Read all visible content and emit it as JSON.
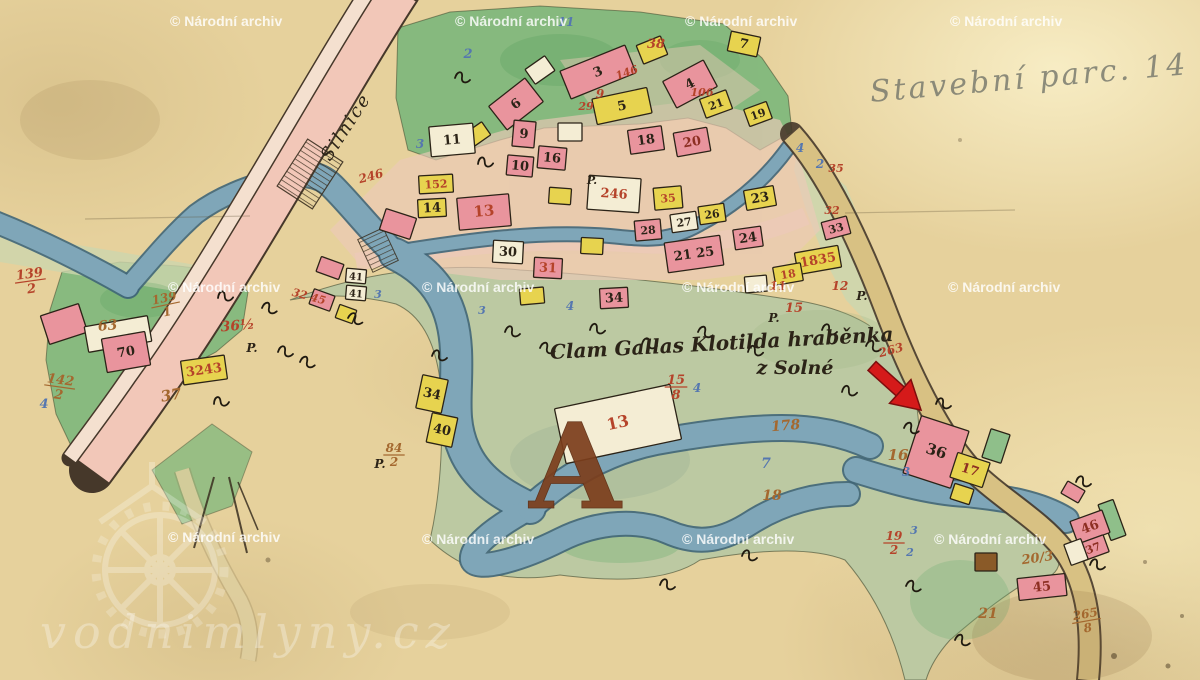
{
  "palette": {
    "paper": "#e6d19c",
    "ink": "#2b2317",
    "pencil": "#73756a",
    "road_pink": "#f2c7b8",
    "road_strip": "#f4e0cf",
    "street_wash": "#ecc9b8",
    "river": "#7fa6b8",
    "tan_road": "#d8c183",
    "path_tan": "#decf9f",
    "green_bright": "#7eb87c",
    "green_sage": "#bcc9a2",
    "green_pale": "#cdd6ae",
    "bldg_pink": "#e9949d",
    "bldg_red": "#dd7580",
    "bldg_yellow": "#e7d34f",
    "bldg_cream": "#f4edd4",
    "bldg_brown": "#8a5a28",
    "bldg_green": "#8fbf8a",
    "label_red": "#b5432a",
    "label_brown": "#a4682f",
    "label_blue": "#5577b0",
    "label_darkred": "#8d2f23",
    "arrow_red": "#d51a1a",
    "arrow_dark": "#7e0d0d"
  },
  "watermark": {
    "text": "© Národní archiv",
    "positions": [
      {
        "x": 170,
        "y": 14
      },
      {
        "x": 455,
        "y": 14
      },
      {
        "x": 685,
        "y": 14
      },
      {
        "x": 950,
        "y": 14
      },
      {
        "x": 168,
        "y": 280
      },
      {
        "x": 422,
        "y": 280
      },
      {
        "x": 682,
        "y": 280
      },
      {
        "x": 948,
        "y": 280
      },
      {
        "x": 168,
        "y": 530
      },
      {
        "x": 422,
        "y": 532
      },
      {
        "x": 682,
        "y": 532
      },
      {
        "x": 934,
        "y": 532
      }
    ]
  },
  "brand": {
    "text": "vodnimlyny.cz"
  },
  "inscriptions": {
    "road": "Silnice",
    "manor1": "Clam Gallas Klotilda hraběnka",
    "manor2": "z Solné",
    "pencil": "Stavební parc. 14",
    "letter": "A"
  },
  "map": {
    "buildings": [
      {
        "x": 598,
        "y": 72,
        "w": 70,
        "h": 30,
        "r": -22,
        "c": "p",
        "t": "3"
      },
      {
        "x": 652,
        "y": 50,
        "w": 26,
        "h": 20,
        "r": -22,
        "c": "y"
      },
      {
        "x": 690,
        "y": 84,
        "w": 46,
        "h": 30,
        "r": -28,
        "c": "p",
        "t": "4"
      },
      {
        "x": 622,
        "y": 106,
        "w": 56,
        "h": 26,
        "r": -12,
        "c": "y",
        "t": "5"
      },
      {
        "x": 540,
        "y": 70,
        "w": 24,
        "h": 18,
        "r": -35,
        "c": "w"
      },
      {
        "x": 516,
        "y": 104,
        "w": 46,
        "h": 30,
        "r": -38,
        "c": "p",
        "t": "6"
      },
      {
        "x": 744,
        "y": 44,
        "w": 30,
        "h": 20,
        "r": 12,
        "c": "y",
        "t": "7"
      },
      {
        "x": 716,
        "y": 104,
        "w": 28,
        "h": 20,
        "r": -20,
        "c": "y",
        "t": "21",
        "fs": 11
      },
      {
        "x": 758,
        "y": 114,
        "w": 24,
        "h": 18,
        "r": -20,
        "c": "y",
        "t": "19",
        "fs": 11
      },
      {
        "x": 646,
        "y": 140,
        "w": 34,
        "h": 24,
        "r": -8,
        "c": "p",
        "t": "18"
      },
      {
        "x": 692,
        "y": 142,
        "w": 34,
        "h": 24,
        "r": -10,
        "c": "p",
        "t": "20",
        "tc": "dr"
      },
      {
        "x": 570,
        "y": 132,
        "w": 24,
        "h": 18,
        "r": 0,
        "c": "w"
      },
      {
        "x": 478,
        "y": 134,
        "w": 20,
        "h": 16,
        "r": -35,
        "c": "y"
      },
      {
        "x": 452,
        "y": 140,
        "w": 44,
        "h": 30,
        "r": -5,
        "c": "w",
        "t": "11"
      },
      {
        "x": 524,
        "y": 134,
        "w": 22,
        "h": 26,
        "r": 5,
        "c": "p",
        "t": "9"
      },
      {
        "x": 520,
        "y": 166,
        "w": 26,
        "h": 20,
        "r": 5,
        "c": "p",
        "t": "10"
      },
      {
        "x": 552,
        "y": 158,
        "w": 28,
        "h": 22,
        "r": 5,
        "c": "p",
        "t": "16"
      },
      {
        "x": 436,
        "y": 184,
        "w": 34,
        "h": 18,
        "r": -3,
        "c": "y",
        "t": "152",
        "tc": "r",
        "fs": 11
      },
      {
        "x": 432,
        "y": 208,
        "w": 28,
        "h": 18,
        "r": -3,
        "c": "y",
        "t": "14"
      },
      {
        "x": 484,
        "y": 212,
        "w": 52,
        "h": 32,
        "r": -5,
        "c": "p",
        "t": "13",
        "tc": "r",
        "fs": 15
      },
      {
        "x": 398,
        "y": 224,
        "w": 32,
        "h": 22,
        "r": 18,
        "c": "p"
      },
      {
        "x": 560,
        "y": 196,
        "w": 22,
        "h": 16,
        "r": 4,
        "c": "y"
      },
      {
        "x": 614,
        "y": 194,
        "w": 52,
        "h": 34,
        "r": 4,
        "c": "cr",
        "t": "246",
        "tc": "r"
      },
      {
        "x": 668,
        "y": 198,
        "w": 28,
        "h": 22,
        "r": -5,
        "c": "y",
        "t": "35",
        "tc": "r",
        "fs": 11
      },
      {
        "x": 684,
        "y": 222,
        "w": 26,
        "h": 18,
        "r": -8,
        "c": "w",
        "t": "27",
        "fs": 11
      },
      {
        "x": 712,
        "y": 214,
        "w": 26,
        "h": 18,
        "r": -8,
        "c": "y",
        "t": "26",
        "fs": 11
      },
      {
        "x": 760,
        "y": 198,
        "w": 30,
        "h": 20,
        "r": -10,
        "c": "y",
        "t": "23"
      },
      {
        "x": 508,
        "y": 252,
        "w": 30,
        "h": 22,
        "r": 3,
        "c": "w",
        "t": "30"
      },
      {
        "x": 548,
        "y": 268,
        "w": 28,
        "h": 20,
        "r": 3,
        "c": "p",
        "t": "31",
        "tc": "r"
      },
      {
        "x": 592,
        "y": 246,
        "w": 22,
        "h": 16,
        "r": 3,
        "c": "y"
      },
      {
        "x": 648,
        "y": 230,
        "w": 26,
        "h": 20,
        "r": -5,
        "c": "p",
        "t": "28",
        "fs": 11
      },
      {
        "x": 694,
        "y": 254,
        "w": 56,
        "h": 30,
        "r": -8,
        "c": "p",
        "t": "21 25"
      },
      {
        "x": 748,
        "y": 238,
        "w": 28,
        "h": 20,
        "r": -8,
        "c": "p",
        "t": "24"
      },
      {
        "x": 836,
        "y": 228,
        "w": 26,
        "h": 18,
        "r": -15,
        "c": "p",
        "t": "33",
        "fs": 11
      },
      {
        "x": 818,
        "y": 260,
        "w": 44,
        "h": 22,
        "r": -10,
        "c": "y",
        "t": "1835",
        "tc": "r"
      },
      {
        "x": 788,
        "y": 274,
        "w": 28,
        "h": 18,
        "r": -10,
        "c": "y",
        "t": "18",
        "tc": "r",
        "fs": 11
      },
      {
        "x": 756,
        "y": 284,
        "w": 22,
        "h": 16,
        "r": -5,
        "c": "w"
      },
      {
        "x": 532,
        "y": 296,
        "w": 24,
        "h": 16,
        "r": -5,
        "c": "y"
      },
      {
        "x": 614,
        "y": 298,
        "w": 28,
        "h": 20,
        "r": -3,
        "c": "p",
        "t": "34"
      },
      {
        "x": 330,
        "y": 268,
        "w": 24,
        "h": 16,
        "r": 20,
        "c": "p"
      },
      {
        "x": 356,
        "y": 276,
        "w": 20,
        "h": 14,
        "r": 5,
        "c": "w",
        "t": "41",
        "fs": 10
      },
      {
        "x": 356,
        "y": 293,
        "w": 20,
        "h": 14,
        "r": 5,
        "c": "w",
        "t": "41",
        "fs": 10
      },
      {
        "x": 322,
        "y": 300,
        "w": 22,
        "h": 16,
        "r": 20,
        "c": "p"
      },
      {
        "x": 346,
        "y": 314,
        "w": 18,
        "h": 14,
        "r": 20,
        "c": "y"
      },
      {
        "x": 64,
        "y": 324,
        "w": 40,
        "h": 30,
        "r": -18,
        "c": "p"
      },
      {
        "x": 118,
        "y": 334,
        "w": 64,
        "h": 26,
        "r": -10,
        "c": "cr"
      },
      {
        "x": 126,
        "y": 352,
        "w": 44,
        "h": 34,
        "r": -10,
        "c": "p",
        "t": "70"
      },
      {
        "x": 204,
        "y": 370,
        "w": 44,
        "h": 24,
        "r": -8,
        "c": "y",
        "t": "3243",
        "tc": "r"
      },
      {
        "x": 432,
        "y": 394,
        "w": 26,
        "h": 34,
        "r": 12,
        "c": "y",
        "t": "34"
      },
      {
        "x": 442,
        "y": 430,
        "w": 26,
        "h": 30,
        "r": 12,
        "c": "y",
        "t": "40"
      },
      {
        "x": 618,
        "y": 424,
        "w": 118,
        "h": 56,
        "r": -12,
        "c": "cr",
        "t": "13",
        "tc": "r",
        "fs": 16
      },
      {
        "x": 936,
        "y": 452,
        "w": 50,
        "h": 60,
        "r": 18,
        "c": "p",
        "t": "36",
        "fs": 15
      },
      {
        "x": 996,
        "y": 446,
        "w": 20,
        "h": 30,
        "r": 18,
        "c": "g"
      },
      {
        "x": 970,
        "y": 470,
        "w": 34,
        "h": 26,
        "r": 18,
        "c": "y",
        "t": "17",
        "tc": "dr"
      },
      {
        "x": 962,
        "y": 494,
        "w": 20,
        "h": 16,
        "r": 18,
        "c": "y"
      },
      {
        "x": 1073,
        "y": 492,
        "w": 20,
        "h": 14,
        "r": 30,
        "c": "p"
      },
      {
        "x": 1112,
        "y": 520,
        "w": 16,
        "h": 38,
        "r": -20,
        "c": "g"
      },
      {
        "x": 1090,
        "y": 527,
        "w": 34,
        "h": 24,
        "r": -20,
        "c": "p",
        "t": "46",
        "tc": "dr"
      },
      {
        "x": 1093,
        "y": 548,
        "w": 28,
        "h": 18,
        "r": -20,
        "c": "p",
        "t": "37",
        "tc": "dr",
        "fs": 11
      },
      {
        "x": 1076,
        "y": 552,
        "w": 18,
        "h": 22,
        "r": -20,
        "c": "w"
      },
      {
        "x": 1042,
        "y": 587,
        "w": 48,
        "h": 22,
        "r": -6,
        "c": "p",
        "t": "45",
        "tc": "dr"
      },
      {
        "x": 986,
        "y": 562,
        "w": 22,
        "h": 18,
        "r": 0,
        "c": "b"
      }
    ],
    "labels": [
      {
        "x": 656,
        "y": 48,
        "t": "38",
        "c": "r",
        "s": 13
      },
      {
        "x": 600,
        "y": 98,
        "t": "9",
        "c": "r",
        "s": 12
      },
      {
        "x": 628,
        "y": 76,
        "t": "146",
        "c": "r",
        "s": 11,
        "r": -20
      },
      {
        "x": 586,
        "y": 110,
        "t": "29",
        "c": "r",
        "s": 11
      },
      {
        "x": 702,
        "y": 96,
        "t": "106",
        "c": "r",
        "s": 11
      },
      {
        "x": 468,
        "y": 58,
        "t": "2",
        "c": "bl",
        "s": 13
      },
      {
        "x": 566,
        "y": 26,
        "t": "11",
        "c": "bl",
        "s": 12
      },
      {
        "x": 420,
        "y": 148,
        "t": "3",
        "c": "bl",
        "s": 12
      },
      {
        "x": 372,
        "y": 180,
        "t": "246",
        "c": "r",
        "s": 12,
        "r": -15
      },
      {
        "x": 30,
        "y": 278,
        "t": "139",
        "b": "2",
        "c": "r",
        "s": 13,
        "r": -8
      },
      {
        "x": 165,
        "y": 302,
        "t": "139",
        "b": "1",
        "c": "br",
        "s": 12,
        "r": -12
      },
      {
        "x": 108,
        "y": 330,
        "t": "63",
        "c": "br",
        "s": 14,
        "r": -5
      },
      {
        "x": 60,
        "y": 384,
        "t": "142",
        "b": "2",
        "c": "br",
        "s": 13,
        "r": 8
      },
      {
        "x": 238,
        "y": 330,
        "t": "36½",
        "c": "r",
        "s": 14,
        "r": -5
      },
      {
        "x": 252,
        "y": 352,
        "t": "P.",
        "c": "k",
        "s": 12
      },
      {
        "x": 172,
        "y": 400,
        "t": "37",
        "c": "br",
        "s": 15,
        "r": -10
      },
      {
        "x": 44,
        "y": 408,
        "t": "4",
        "c": "bl",
        "s": 13
      },
      {
        "x": 308,
        "y": 300,
        "t": "32 45",
        "c": "r",
        "s": 11,
        "r": 15
      },
      {
        "x": 394,
        "y": 452,
        "t": "84",
        "b": "2",
        "c": "br",
        "s": 12
      },
      {
        "x": 380,
        "y": 468,
        "t": "P.",
        "c": "k",
        "s": 12
      },
      {
        "x": 676,
        "y": 384,
        "t": "15",
        "b": "8",
        "c": "r",
        "s": 13
      },
      {
        "x": 697,
        "y": 392,
        "t": "4",
        "c": "bl",
        "s": 12
      },
      {
        "x": 786,
        "y": 430,
        "t": "178",
        "c": "br",
        "s": 14,
        "r": -5
      },
      {
        "x": 898,
        "y": 460,
        "t": "16",
        "c": "br",
        "s": 15
      },
      {
        "x": 906,
        "y": 476,
        "t": "3",
        "c": "bl",
        "s": 12
      },
      {
        "x": 766,
        "y": 468,
        "t": "7",
        "c": "bl",
        "s": 14
      },
      {
        "x": 772,
        "y": 500,
        "t": "18",
        "c": "br",
        "s": 14
      },
      {
        "x": 894,
        "y": 540,
        "t": "19",
        "b": "2",
        "c": "r",
        "s": 12
      },
      {
        "x": 914,
        "y": 534,
        "t": "3",
        "c": "bl",
        "s": 11
      },
      {
        "x": 910,
        "y": 556,
        "t": "2",
        "c": "bl",
        "s": 11
      },
      {
        "x": 1038,
        "y": 562,
        "t": "20/3",
        "c": "br",
        "s": 13,
        "r": -8
      },
      {
        "x": 988,
        "y": 618,
        "t": "21",
        "c": "br",
        "s": 14
      },
      {
        "x": 1086,
        "y": 618,
        "t": "265",
        "b": "8",
        "c": "br",
        "s": 12,
        "r": -10
      },
      {
        "x": 892,
        "y": 354,
        "t": "263",
        "c": "r",
        "s": 12,
        "r": -15
      },
      {
        "x": 862,
        "y": 300,
        "t": "P.",
        "c": "k",
        "s": 12
      },
      {
        "x": 774,
        "y": 322,
        "t": "P.",
        "c": "k",
        "s": 12
      },
      {
        "x": 592,
        "y": 184,
        "t": "P.",
        "c": "k",
        "s": 11
      },
      {
        "x": 778,
        "y": 290,
        "t": "11",
        "c": "r",
        "s": 12
      },
      {
        "x": 840,
        "y": 290,
        "t": "12",
        "c": "r",
        "s": 12
      },
      {
        "x": 794,
        "y": 312,
        "t": "15",
        "c": "r",
        "s": 13
      },
      {
        "x": 836,
        "y": 172,
        "t": "35",
        "c": "r",
        "s": 11
      },
      {
        "x": 832,
        "y": 214,
        "t": "32",
        "c": "r",
        "s": 11
      },
      {
        "x": 820,
        "y": 168,
        "t": "2",
        "c": "bl",
        "s": 12
      },
      {
        "x": 800,
        "y": 152,
        "t": "4",
        "c": "bl",
        "s": 12
      },
      {
        "x": 570,
        "y": 310,
        "t": "4",
        "c": "bl",
        "s": 12
      },
      {
        "x": 482,
        "y": 314,
        "t": "3",
        "c": "bl",
        "s": 11
      },
      {
        "x": 378,
        "y": 298,
        "t": "3",
        "c": "bl",
        "s": 11
      }
    ],
    "squiggles": [
      {
        "x": 218,
        "y": 298,
        "r": -10
      },
      {
        "x": 262,
        "y": 308,
        "r": 5
      },
      {
        "x": 278,
        "y": 352,
        "r": 0
      },
      {
        "x": 214,
        "y": 404,
        "r": -15
      },
      {
        "x": 348,
        "y": 318,
        "r": 10
      },
      {
        "x": 505,
        "y": 332,
        "r": 0
      },
      {
        "x": 540,
        "y": 348,
        "r": 5
      },
      {
        "x": 590,
        "y": 330,
        "r": -5
      },
      {
        "x": 642,
        "y": 344,
        "r": 0
      },
      {
        "x": 698,
        "y": 332,
        "r": 5
      },
      {
        "x": 748,
        "y": 352,
        "r": -5
      },
      {
        "x": 822,
        "y": 330,
        "r": 0
      },
      {
        "x": 866,
        "y": 346,
        "r": 5
      },
      {
        "x": 842,
        "y": 392,
        "r": -5
      },
      {
        "x": 936,
        "y": 404,
        "r": 0
      },
      {
        "x": 904,
        "y": 428,
        "r": 5
      },
      {
        "x": 742,
        "y": 556,
        "r": 0
      },
      {
        "x": 906,
        "y": 586,
        "r": 5
      },
      {
        "x": 1076,
        "y": 482,
        "r": 0
      },
      {
        "x": 432,
        "y": 356,
        "r": 0
      },
      {
        "x": 300,
        "y": 362,
        "r": 5
      },
      {
        "x": 455,
        "y": 78,
        "r": 0
      },
      {
        "x": 478,
        "y": 164,
        "r": -10
      },
      {
        "x": 660,
        "y": 585,
        "r": 0
      },
      {
        "x": 955,
        "y": 640,
        "r": 5
      },
      {
        "x": 1090,
        "y": 565,
        "r": 0
      }
    ]
  }
}
